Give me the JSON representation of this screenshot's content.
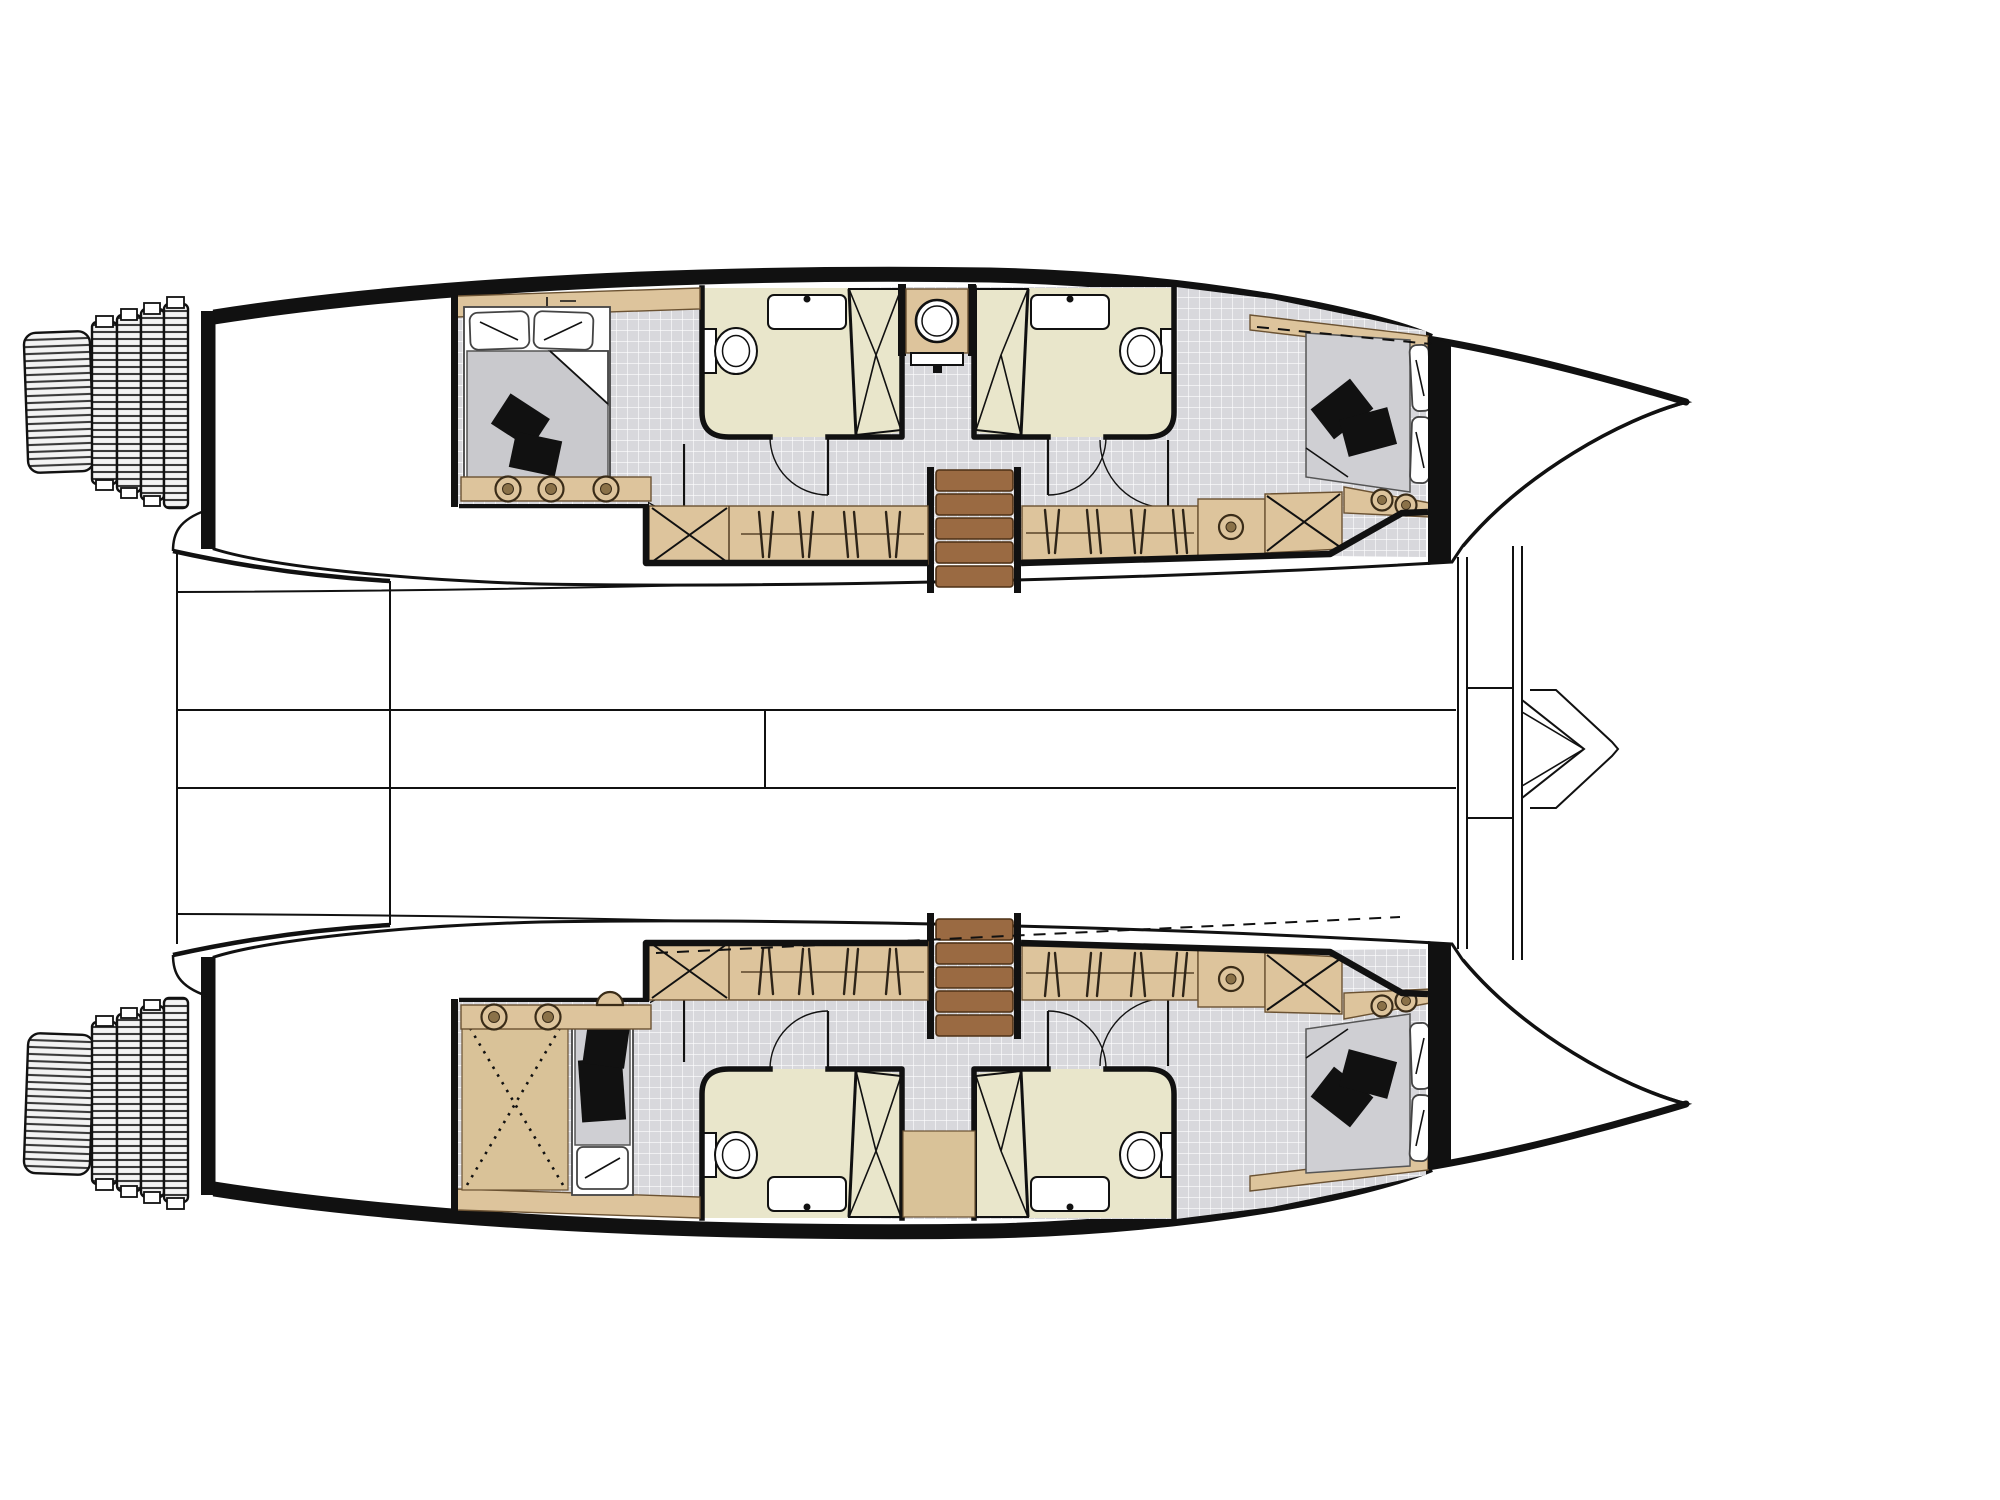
{
  "description": "Top-view interior floor plan of a sailing catamaran lower deck: two parallel hulls with bows pointing right, stern bathing-platform steps on the left of each hull, four bathrooms, two double cabins per side, central companionway stairs in each hull, wardrobes, a crossed-out technical area in the starboard hull, bridge-deck lines and a forward crossbeam with bowsprit between the hulls. No text labels are rendered in the drawing.",
  "colors": {
    "ink": "#111111",
    "hullWhite": "#ffffff",
    "floorTile": "#d8d8dc",
    "floorTileLine": "#ffffff",
    "bathroom": "#e9e6cb",
    "wood": "#ddc49c",
    "woodLight": "#d9c298",
    "woodEdge": "#6b5232",
    "stairs": "#9a6a42",
    "stairsEdge": "#4d3015",
    "mattress": "#cfcfd3",
    "blanketGray": "#c9c9cd",
    "cushion": "#111111"
  },
  "layout": {
    "orientation": "bows-to-the-right, sterns-to-the-left",
    "hulls": [
      {
        "id": "port-hull-top",
        "spaces": [
          "stern-steps",
          "aft-deck",
          "aft-double-cabin-with-bed",
          "aft-bathroom-with-sink-toilet-shower",
          "washbasin-compartment",
          "forward-bathroom-with-sink-toilet-shower",
          "companionway-stairs",
          "wardrobes-and-lockers",
          "forward-double-cabin-with-bed",
          "bow-compartment"
        ]
      },
      {
        "id": "starboard-hull-bottom",
        "spaces": [
          "stern-steps",
          "aft-deck",
          "technical-area-crossed-out",
          "single-berth",
          "aft-bathroom-with-sink-toilet-shower",
          "landing-patch",
          "forward-bathroom-with-sink-toilet-shower",
          "companionway-stairs",
          "wardrobes-and-lockers",
          "forward-double-cabin-with-bed",
          "bow-compartment"
        ]
      }
    ],
    "bridge_deck": [
      "aft-cockpit-curves",
      "longitudinal-deck-lines",
      "forward-crossbeam",
      "bowsprit-with-seagull-striker"
    ]
  }
}
